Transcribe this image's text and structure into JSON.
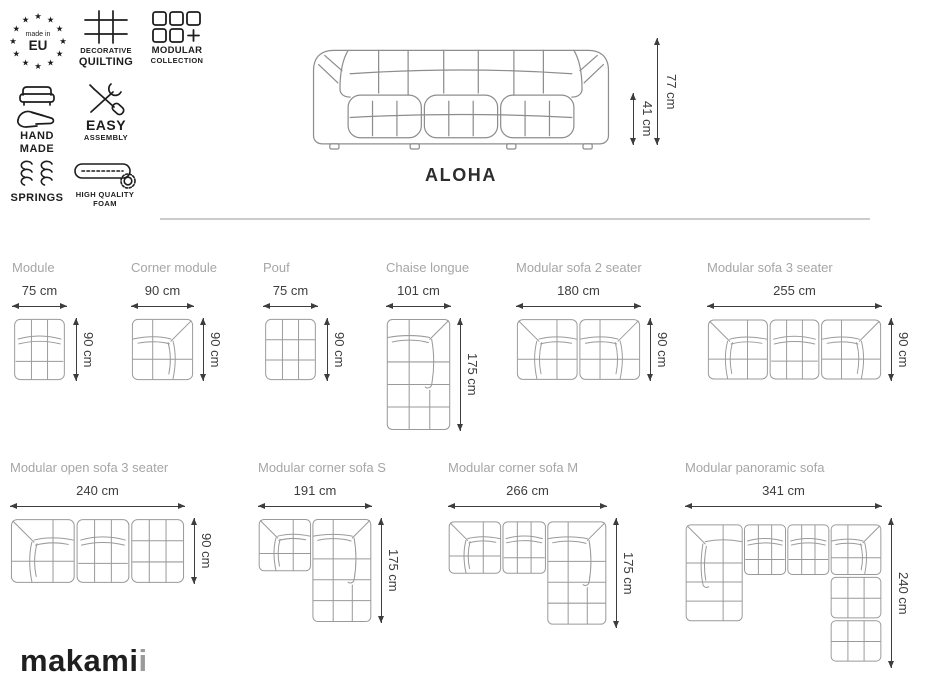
{
  "colors": {
    "icon": "#1d1d1d",
    "label_gray": "#a6a6a6",
    "dimension_dark": "#3d3d3d",
    "drawing_line": "#9a9a9a",
    "divider": "#cbcbcb",
    "logo": "#1f1f1f",
    "logo_accent": "#9a9a9a"
  },
  "badges": {
    "made_in_eu": {
      "line1": "made in",
      "line2": "EU"
    },
    "decorative_quilting": {
      "line1": "DECORATIVE",
      "line2": "QUILTING"
    },
    "modular_collection": {
      "line1": "MODULAR",
      "line2": "COLLECTION"
    },
    "hand_made": {
      "line1": "HAND",
      "line2": "MADE"
    },
    "easy_assembly": {
      "line1": "EASY",
      "line2": "ASSEMBLY"
    },
    "springs": {
      "label": "SPRINGS"
    },
    "high_quality_foam": {
      "line1": "HIGH QUALITY",
      "line2": "FOAM"
    }
  },
  "hero": {
    "product_name": "ALOHA",
    "total_height": "77 cm",
    "seat_height": "41 cm"
  },
  "diagrams": {
    "row1": [
      {
        "name": "Module",
        "width": "75 cm",
        "height": "90 cm"
      },
      {
        "name": "Corner module",
        "width": "90 cm",
        "height": "90 cm"
      },
      {
        "name": "Pouf",
        "width": "75 cm",
        "height": "90 cm"
      },
      {
        "name": "Chaise longue",
        "width": "101 cm",
        "height": "175 cm"
      },
      {
        "name": "Modular sofa 2 seater",
        "width": "180 cm",
        "height": "90 cm"
      },
      {
        "name": "Modular sofa 3 seater",
        "width": "255 cm",
        "height": "90 cm"
      }
    ],
    "row2": [
      {
        "name": "Modular open sofa 3 seater",
        "width": "240 cm",
        "height": "90 cm"
      },
      {
        "name": "Modular corner sofa S",
        "width": "191 cm",
        "height": "175 cm"
      },
      {
        "name": "Modular corner sofa M",
        "width": "266 cm",
        "height": "175 cm"
      },
      {
        "name": "Modular panoramic sofa",
        "width": "341 cm",
        "height": "240 cm"
      }
    ]
  },
  "logo": {
    "main": "makami",
    "accent": "i"
  }
}
